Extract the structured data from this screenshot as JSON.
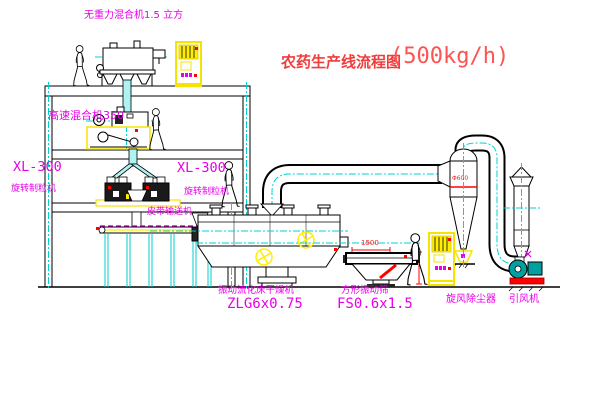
{
  "title": {
    "cn": "农药生产线流程图",
    "capacity": "(500kg/h)"
  },
  "labels": {
    "top_mixer": "无重力混合机1.5 立方",
    "high_speed_mixer": "高速混合机350",
    "granulator_left_model": "XL-300",
    "granulator_left_name": "旋转制粒机",
    "granulator_mid_model": "XL-300",
    "granulator_mid_name": "旋转制粒机",
    "belt_conveyor": "皮带输送机",
    "dryer_name": "振动流化床干燥机",
    "dryer_model": "ZLG6x0.75",
    "sieve_name": "方形振动筛",
    "sieve_model": "FS0.6x1.5",
    "cyclone_name": "旋风除尘器",
    "fan_name": "引风机"
  },
  "dimensions": {
    "sieve_length": "1500",
    "cyclone_dia": "Φ600"
  },
  "colors": {
    "label_magenta": "#e800e8",
    "title_red": "#f03c3c",
    "line_cyan": "#00d2d2",
    "machine_yellow": "#f5e400",
    "alert_red": "#ff0000",
    "fan_teal": "#00a0a0"
  }
}
